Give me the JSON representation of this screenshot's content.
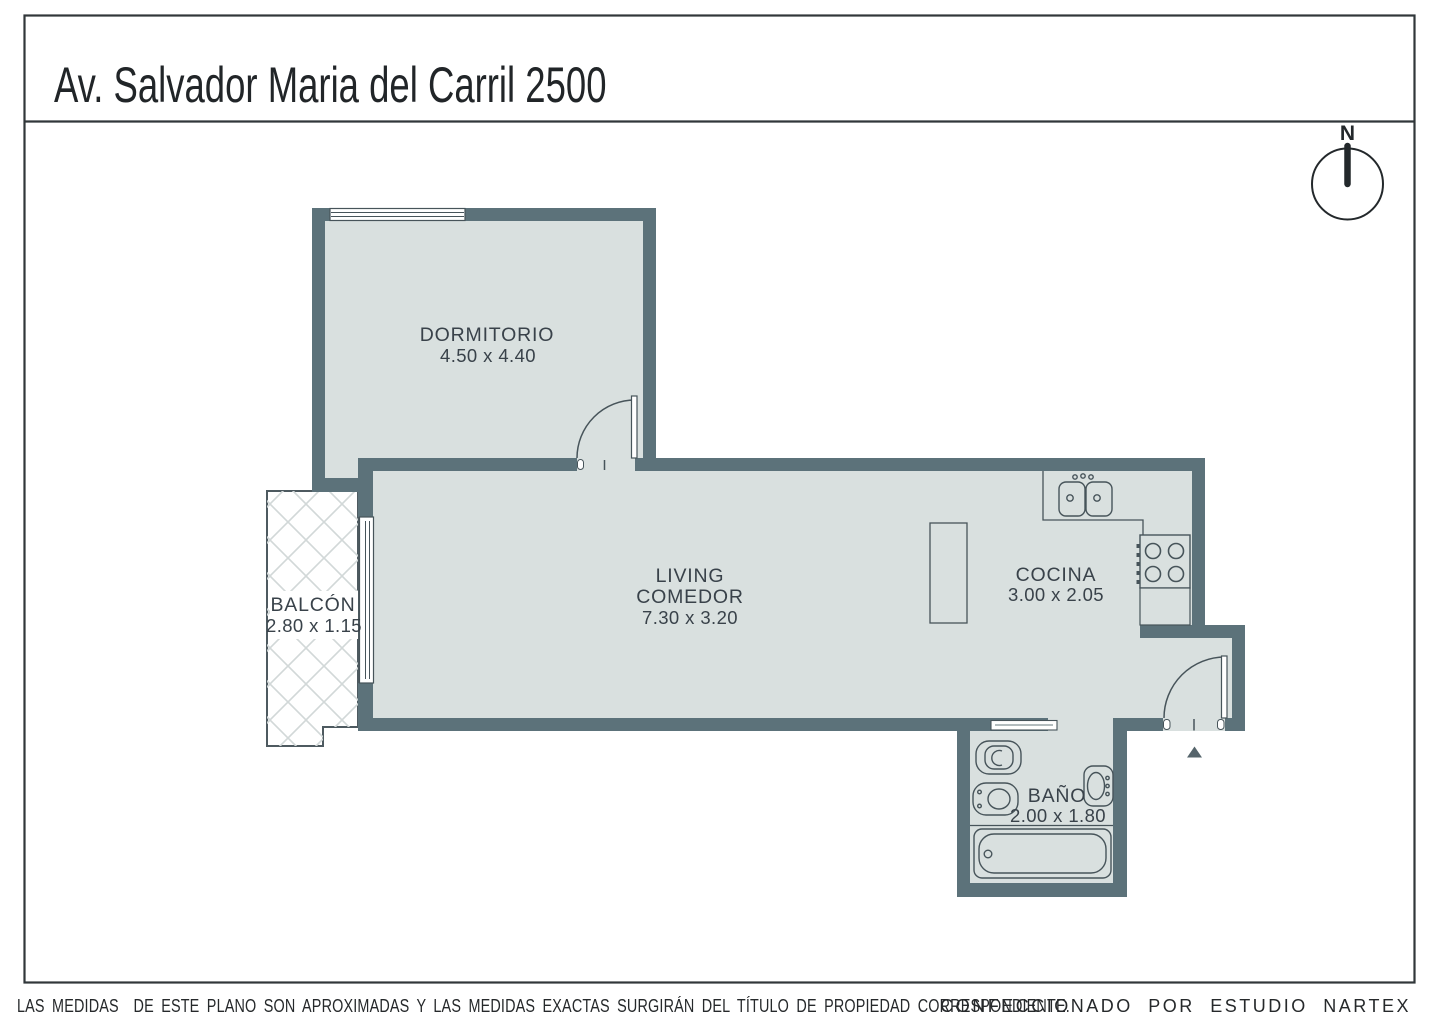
{
  "title": "Av. Salvador Maria del Carril 2500",
  "compass": {
    "label": "N"
  },
  "rooms": {
    "dormitorio": {
      "name": "DORMITORIO",
      "dims": "4.50 x 4.40"
    },
    "living": {
      "line1": "LIVING",
      "line2": "COMEDOR",
      "dims": "7.30 x 3.20"
    },
    "cocina": {
      "name": "COCINA",
      "dims": "3.00 x 2.05"
    },
    "balcon": {
      "name": "BALCÓN",
      "dims": "2.80 x 1.15"
    },
    "bano": {
      "name": "BAÑO",
      "dims": "2.00 x 1.80"
    }
  },
  "footer": {
    "disclaimer": "LAS MEDIDAS  DE ESTE PLANO SON APROXIMADAS Y LAS MEDIDAS EXACTAS SURGIRÁN DEL TÍTULO DE PROPIEDAD CORRESPONDIENTE.",
    "credit": "CONFECCIONADO POR ESTUDIO NARTEX"
  },
  "colors": {
    "wall": "#5c727a",
    "floor": "#d9e0df",
    "fixture_line": "#47545a",
    "hatch_line": "#d2d8d8",
    "border": "#31373a",
    "text": "#39424a"
  }
}
